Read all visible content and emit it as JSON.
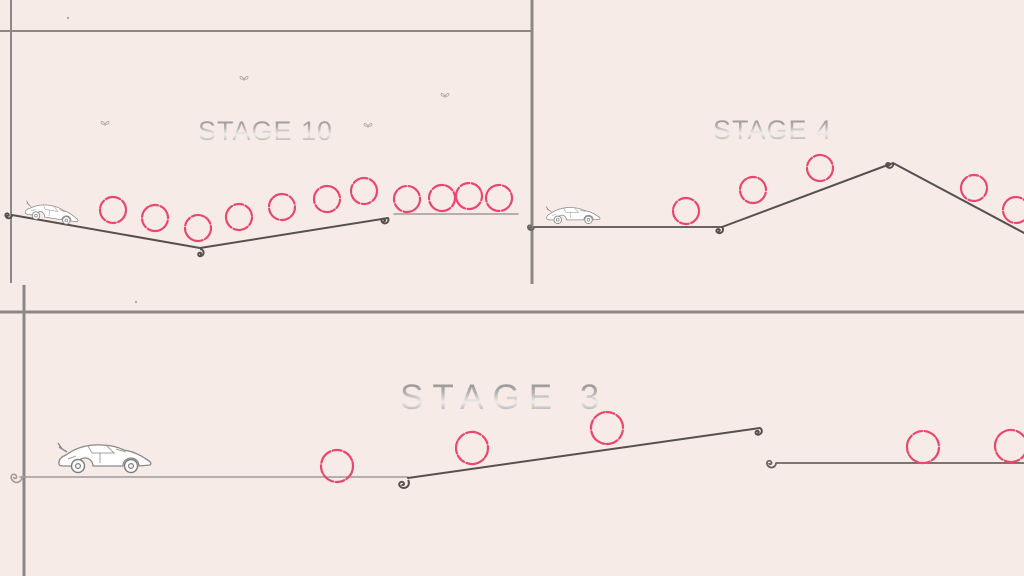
{
  "screen": {
    "title": "Stage preview screen",
    "width": 1024,
    "height": 576
  },
  "colors": {
    "background": "#f7ebe7",
    "frame_line": "#8c8886",
    "terrain_dark": "#57514e",
    "terrain_mid": "#6a6562",
    "terrain_light": "#a09a98",
    "ring": "#e8486d",
    "car_stroke": "#8a8a8a",
    "butterfly": "#9a948f",
    "speck": "#b9a8a4"
  },
  "frame_lines": [
    {
      "x1": 11,
      "y1": 0,
      "x2": 11,
      "y2": 283,
      "width": 2
    },
    {
      "x1": 0,
      "y1": 31,
      "x2": 532,
      "y2": 31,
      "width": 2
    },
    {
      "x1": 532,
      "y1": 0,
      "x2": 532,
      "y2": 284,
      "width": 3
    },
    {
      "x1": 0,
      "y1": 312,
      "x2": 1024,
      "y2": 312,
      "width": 3
    },
    {
      "x1": 24,
      "y1": 285,
      "x2": 24,
      "y2": 576,
      "width": 3
    }
  ],
  "panels": [
    {
      "id": "stage-panel-10",
      "x": 0,
      "y": 0,
      "w": 532,
      "h": 312
    },
    {
      "id": "stage-panel-4",
      "x": 532,
      "y": 0,
      "w": 492,
      "h": 312
    },
    {
      "id": "stage-panel-3",
      "x": 0,
      "y": 312,
      "w": 1024,
      "h": 264
    }
  ],
  "specks": [
    [
      68,
      18
    ],
    [
      136,
      302
    ]
  ],
  "stages": [
    {
      "id": "stage-10",
      "label": "STAGE 10",
      "title": {
        "x": 198,
        "y": 116,
        "size": 27,
        "spacing": 1
      },
      "terrain": [
        {
          "points": [
            [
              12,
              215
            ],
            [
              200,
              248
            ],
            [
              388,
              218
            ]
          ],
          "color": "#57514e",
          "width": 2,
          "curls": [
            {
              "x": 12,
              "y": 215,
              "s": 0.55,
              "r": 0
            },
            {
              "x": 200,
              "y": 249,
              "s": 0.6,
              "r": -90
            },
            {
              "x": 388,
              "y": 218,
              "s": 0.6,
              "r": -30
            }
          ]
        },
        {
          "points": [
            [
              394,
              214
            ],
            [
              518,
              214
            ]
          ],
          "color": "#a09a98",
          "width": 1.6,
          "curls": []
        }
      ],
      "rings": {
        "radius": 13,
        "positions": [
          [
            113,
            210
          ],
          [
            155,
            218
          ],
          [
            198,
            228
          ],
          [
            239,
            217
          ],
          [
            282,
            207
          ],
          [
            327,
            199
          ],
          [
            364,
            191
          ],
          [
            407,
            199
          ],
          [
            442,
            198
          ],
          [
            469,
            196
          ],
          [
            499,
            198
          ]
        ]
      },
      "car": {
        "x": 26,
        "y": 197,
        "scale": 0.58,
        "angle": 9
      },
      "butterflies": [
        [
          100,
          120
        ],
        [
          239,
          75
        ],
        [
          363,
          122
        ],
        [
          440,
          92
        ]
      ]
    },
    {
      "id": "stage-4",
      "label": "STAGE 4",
      "title": {
        "x": 713,
        "y": 115,
        "size": 27,
        "spacing": 1
      },
      "terrain": [
        {
          "points": [
            [
              534,
              227
            ],
            [
              722,
              227
            ]
          ],
          "color": "#6a6562",
          "width": 2,
          "curls": [
            {
              "x": 534,
              "y": 227,
              "s": 0.5,
              "r": 0
            }
          ]
        },
        {
          "points": [
            [
              722,
              227
            ],
            [
              893,
              163
            ],
            [
              1026,
              234
            ]
          ],
          "color": "#57514e",
          "width": 2,
          "curls": [
            {
              "x": 722,
              "y": 227,
              "s": 0.6,
              "r": -45
            },
            {
              "x": 893,
              "y": 163,
              "s": 0.6,
              "r": -20
            }
          ]
        }
      ],
      "rings": {
        "radius": 13,
        "positions": [
          [
            686,
            211
          ],
          [
            753,
            190
          ],
          [
            820,
            168
          ],
          [
            974,
            188
          ],
          [
            1016,
            210
          ]
        ]
      },
      "car": {
        "x": 545,
        "y": 203,
        "scale": 0.58,
        "angle": 0
      },
      "butterflies": []
    },
    {
      "id": "stage-3",
      "label": "STAGE 3",
      "title": {
        "x": 400,
        "y": 378,
        "size": 35,
        "spacing": 9
      },
      "terrain": [
        {
          "points": [
            [
              20,
              477
            ],
            [
              408,
              477
            ]
          ],
          "color": "#a09a98",
          "width": 1.6,
          "curls": [
            {
              "x": 22,
              "y": 477,
              "s": 0.9,
              "r": 0
            }
          ]
        },
        {
          "points": [
            [
              408,
              478
            ],
            [
              760,
              428
            ]
          ],
          "color": "#57514e",
          "width": 2,
          "curls": [
            {
              "x": 408,
              "y": 480,
              "s": 0.85,
              "r": -35
            },
            {
              "x": 760,
              "y": 428,
              "s": 0.6,
              "r": -60
            }
          ]
        },
        {
          "points": [
            [
              776,
              463
            ],
            [
              1026,
              463
            ]
          ],
          "color": "#6a6562",
          "width": 1.8,
          "curls": [
            {
              "x": 776,
              "y": 463,
              "s": 0.75,
              "r": 0
            }
          ]
        }
      ],
      "rings": {
        "radius": 16,
        "positions": [
          [
            337,
            466
          ],
          [
            472,
            448
          ],
          [
            607,
            428
          ],
          [
            923,
            447
          ],
          [
            1011,
            446
          ]
        ]
      },
      "car": {
        "x": 56,
        "y": 437,
        "scale": 1.0,
        "angle": 0
      },
      "butterflies": []
    }
  ]
}
